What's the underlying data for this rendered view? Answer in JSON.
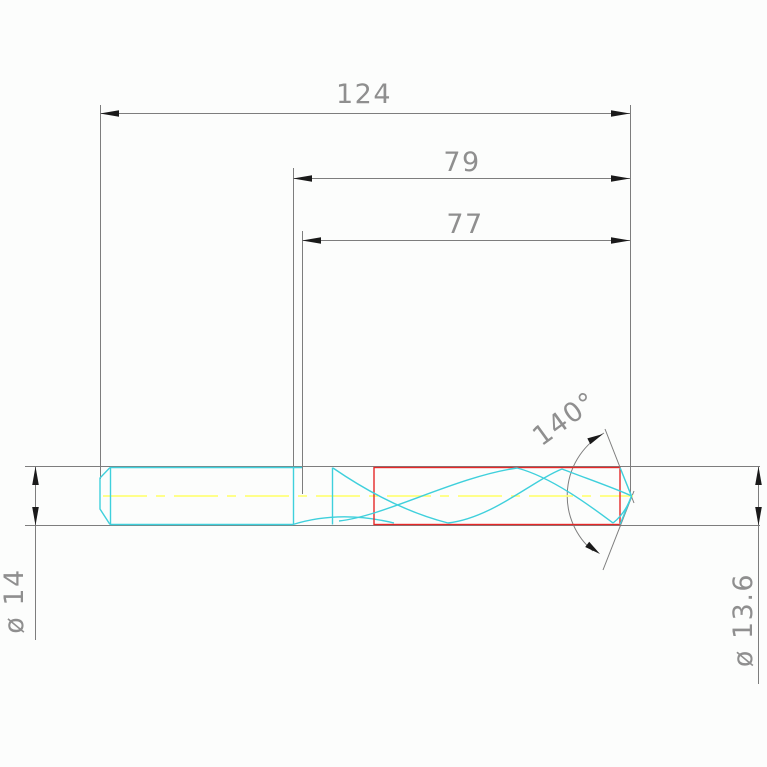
{
  "drawing": {
    "kind": "technical-drawing-twist-drill",
    "dimensions": {
      "total_length": {
        "label": "124"
      },
      "intermediate_length": {
        "label": "79"
      },
      "flute_length": {
        "label": "77"
      },
      "point_angle": {
        "label": "140°"
      },
      "shank_diameter": {
        "label": "ø 14"
      },
      "point_diameter": {
        "label": "ø 13.6"
      }
    },
    "colors": {
      "background": "#fcfdfc",
      "outline": "#3fd0dc",
      "highlight": "#e62828",
      "centerline": "#ffff7a",
      "dim_line": "#7d7d7d",
      "dim_text": "#8f8f8f",
      "arrow": "#1a1a1a"
    }
  }
}
